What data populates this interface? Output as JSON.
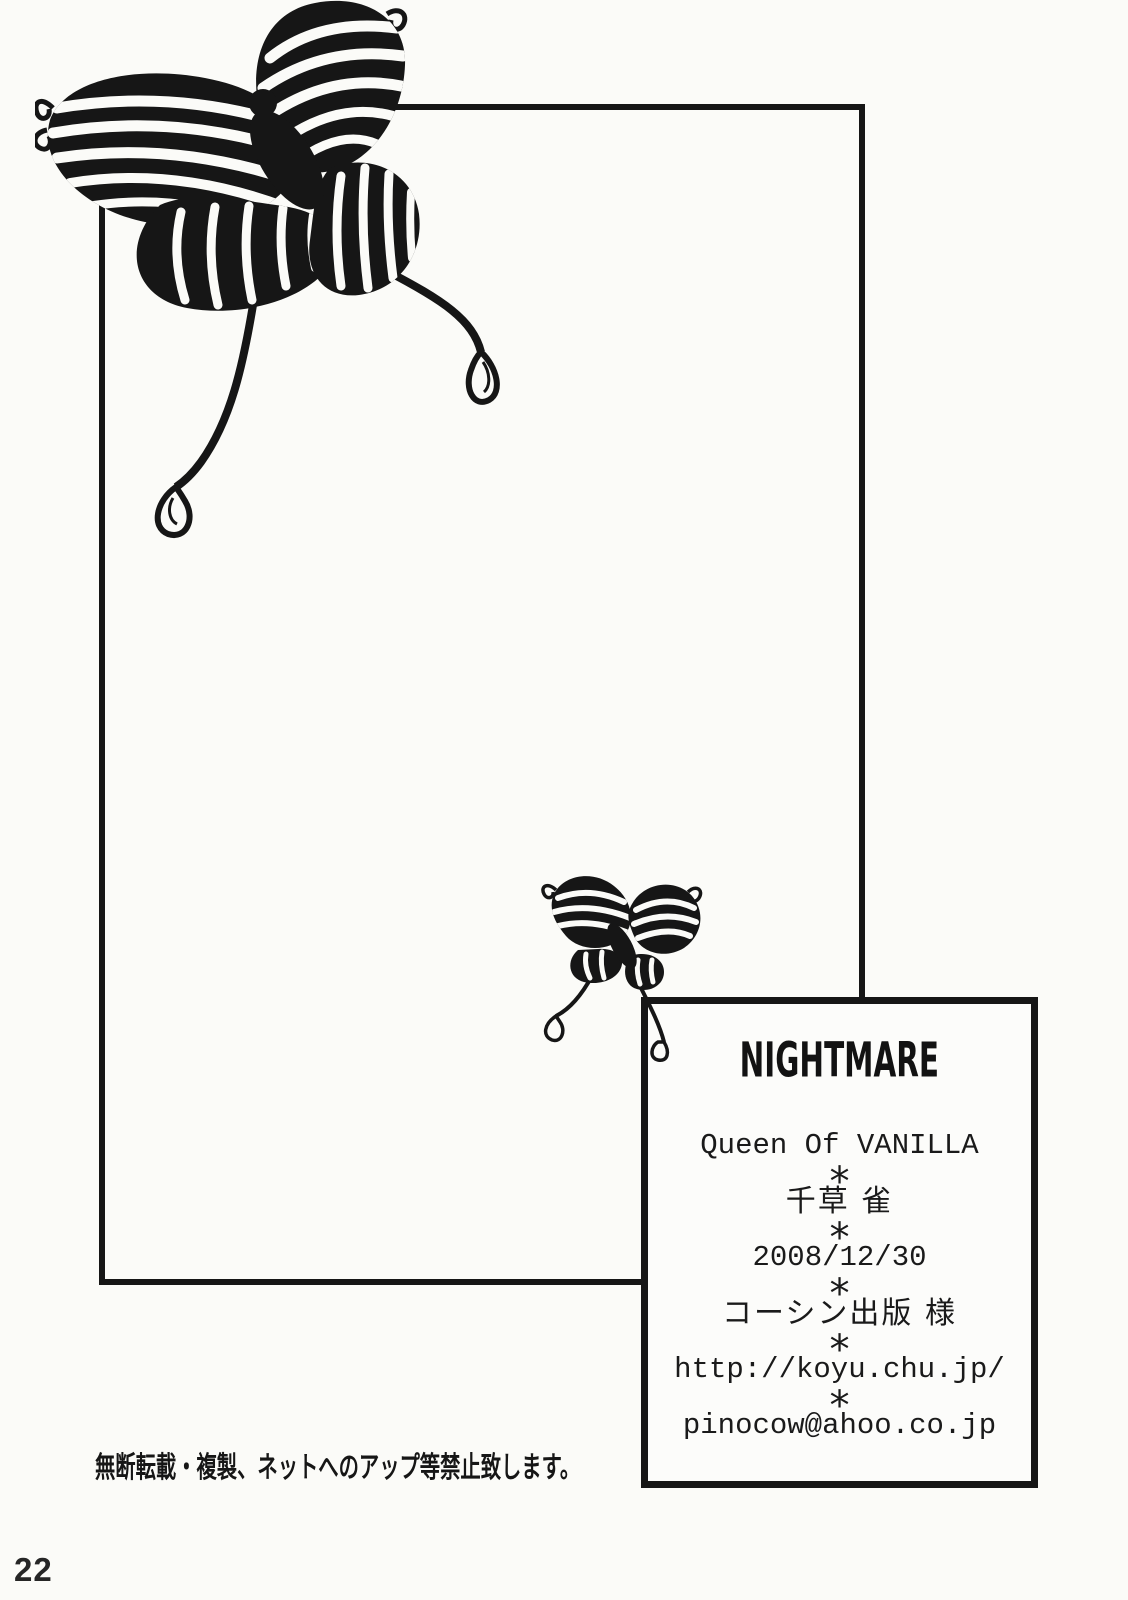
{
  "page": {
    "page_number": "22",
    "disclaimer": "無断転載・複製、ネットへのアップ等禁止致します。"
  },
  "credits_box": {
    "logo": "NIGHTMARE",
    "separator": "*",
    "title": "Queen Of VANILLA",
    "author": "千草 雀",
    "date": "2008/12/30",
    "printer": "コーシン出版 様",
    "website": "http://koyu.chu.jp/",
    "email": "pinocow@ahoo.co.jp"
  },
  "decorations": {
    "large_butterfly": "butterfly-line-art-large",
    "small_butterfly": "butterfly-line-art-small"
  },
  "colors": {
    "ink": "#161616",
    "paper": "#fbfbf8"
  }
}
